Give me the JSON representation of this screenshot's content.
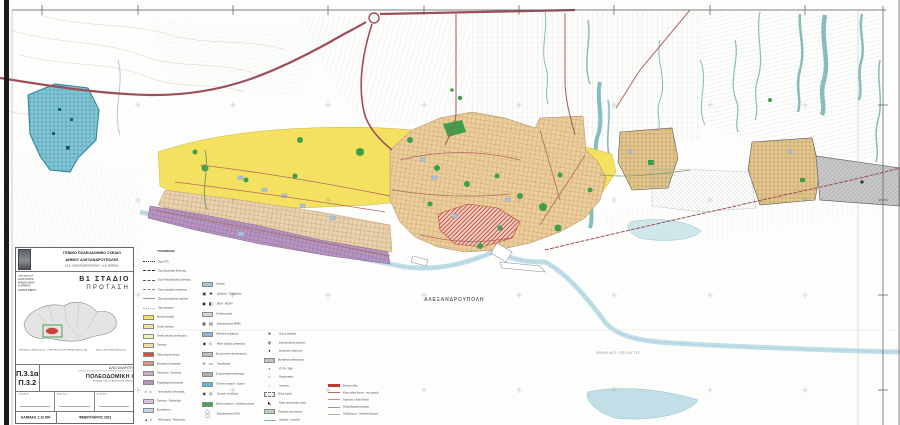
{
  "map": {
    "labels": {
      "city": "ΑΛΕΞΑΝΔΡΟΥΠΟΛΗ",
      "sea": "ΘΡΑΚΙΚΟ ΠΕΛΑΓΟΣ"
    },
    "colors": {
      "water": "#6fb3b4",
      "shore_band": "#b9dbe6",
      "highway_red": "#9d4e56",
      "road_red": "#b06a62",
      "residential_yellow": "#f4e15f",
      "urban_tan": "#ebcf9b",
      "west_tan": "#e8d2b0",
      "center_red": "#e2574a",
      "coastal_purple": "#b796c1",
      "park_green": "#3f9e4c",
      "military_blue": "#85c8d6",
      "airport_gray": "#c9c9c9",
      "lavender_blue": "#a9c4e2",
      "settlement_tan": "#e6c98f",
      "parcel_gray": "#d6d6d6"
    }
  },
  "legend": {
    "title": "ΥΠΟΜΝΗΜΑ",
    "columns": [
      {
        "entries": [
          {
            "t": "line",
            "ls": "dotted",
            "c": "#222222",
            "label": "Όριο ΓΠΣ"
          },
          {
            "t": "line",
            "ls": "dashed",
            "c": "#333333",
            "label": "Όριο Δημοτικής Ενότητας"
          },
          {
            "t": "line",
            "ls": "dashed",
            "c": "#555555",
            "label": "Όριο Πολεοδομικής Ενότητας"
          },
          {
            "t": "line",
            "ls": "dashed",
            "c": "#888888",
            "label": "Όριο περιοχής επέκτασης"
          },
          {
            "t": "line",
            "ls": "solid",
            "c": "#999999",
            "label": "Όριο εγκεκριμένου σχεδίου"
          },
          {
            "t": "line",
            "ls": "dotted",
            "c": "#aaaaaa",
            "label": "Όριο οικισμού"
          },
          {
            "t": "sw",
            "c": "#f4e15f",
            "label": "Αμιγής κατοικία"
          },
          {
            "t": "sw",
            "c": "#f6e78e",
            "label": "Γενική κατοικία"
          },
          {
            "t": "sw",
            "c": "#f4eec0",
            "label": "Γενική κατοικία (επέκταση)"
          },
          {
            "t": "sw",
            "c": "#efdfae",
            "label": "Οικισμοί"
          },
          {
            "t": "sw",
            "c": "#e2574a",
            "hatch": "#b23c33",
            "label": "Πολεοδομικό κέντρο"
          },
          {
            "t": "sw",
            "c": "#e0908a",
            "label": "Κεντρικές λειτουργίες"
          },
          {
            "t": "sw",
            "c": "#cfa8c8",
            "label": "Τουρισμός - Αναψυχή"
          },
          {
            "t": "sw",
            "c": "#b392bd",
            "label": "Παραθεριστική κατοικία"
          },
          {
            "t": "ic",
            "g": "▪ ⌂",
            "label": "Κοινωφελείς λειτουργίες"
          },
          {
            "t": "sw",
            "c": "#d9c6de",
            "label": "Πρόνοια - Περίθαλψη"
          },
          {
            "t": "sw",
            "c": "#bcd7e8",
            "label": "Εκπαίδευση"
          },
          {
            "t": "ic",
            "g": "▴ ▪",
            "label": "Αθλητισμός - Πολιτισμός"
          }
        ]
      },
      {
        "entries": [
          {
            "t": "sw",
            "c": "#9fc6d8",
            "label": "Λιμένας"
          },
          {
            "t": "ic",
            "g": "▣ ✚",
            "label": "Διοίκηση - Περίθαλψη"
          },
          {
            "t": "ic",
            "g": "◼ ◧",
            "label": "ΒΙΠΑ - ΒΙΟΠΑ"
          },
          {
            "t": "sw",
            "c": "#cfd8e2",
            "label": "Χονδρεμπόριο"
          },
          {
            "t": "ic",
            "g": "▦ ▤",
            "label": "Εγκαταστάσεις ΜΜΜ"
          },
          {
            "t": "sw",
            "c": "#8fb6d9",
            "label": "Αλιευτικό καταφύγιο"
          },
          {
            "t": "ic",
            "g": "◆ ◇",
            "label": "Μέσα μαζικής μεταφοράς"
          },
          {
            "t": "sw",
            "c": "#b5bfc9",
            "label": "Στρατιωτικές εγκαταστάσεις"
          },
          {
            "t": "ic",
            "g": "✈ ▭",
            "label": "Αεροδρόμιο"
          },
          {
            "t": "sw",
            "c": "#a9b2ba",
            "label": "Σωφρονιστικό κατάστημα"
          },
          {
            "t": "sw",
            "c": "#63b9cf",
            "label": "Υδάτινα στοιχεία - ρέματα"
          },
          {
            "t": "ic",
            "g": "◉ ◎",
            "label": "Τεχνικές υποδομές"
          },
          {
            "t": "sw",
            "c": "#46a45a",
            "label": "Αστικό πράσινο - ελεύθεροι χώροι"
          },
          {
            "t": "ic",
            "g": "◯ ◯",
            "label": "Εγκαταστάσεις ΟΚΩ"
          }
        ]
      },
      {
        "entries": [
          {
            "t": "ic",
            "g": "⊕",
            "label": "Χώροι λατρείας"
          },
          {
            "t": "ic",
            "g": "◍",
            "label": "Εγκαταστάσεις κεραιών"
          },
          {
            "t": "ic",
            "g": "●",
            "label": "Δεξαμενές ύδρευσης"
          },
          {
            "t": "sw",
            "c": "#d4d4d4",
            "hatch": "#9a9a9a",
            "label": "Βιολογικός καθαρισμός"
          },
          {
            "t": "ic",
            "g": "◐",
            "label": "ΧΥΤΑ - ΣΜΑ"
          },
          {
            "t": "ic",
            "g": "○",
            "label": "Νεκροταφείο"
          },
          {
            "t": "ic",
            "g": "◌",
            "label": "Λατομείο"
          },
          {
            "t": "swd",
            "c": "#efefef",
            "label": "Ζώνη λιμένα"
          },
          {
            "t": "ic",
            "g": "◣",
            "label": "Έργα προστασίας ακτής"
          },
          {
            "t": "sw",
            "c": "#cfe3cf",
            "hatch": "#7fae7f",
            "label": "Περιοχές προστασίας"
          },
          {
            "t": "line",
            "ls": "solid",
            "c": "#7ab0c0",
            "label": "Αιγιαλός - παραλία"
          },
          {
            "t": "line",
            "ls": "solid",
            "c": "#9ac0cc",
            "label": "Ρέμα"
          }
        ]
      },
      {
        "entries": [
          {
            "t": "line",
            "ls": "thickred",
            "c": "#c23b35",
            "label": "Εγνατία οδός"
          },
          {
            "t": "line",
            "ls": "solid",
            "c": "#b06a62",
            "label": "Κύριο οδικό δίκτυο - νέα χάραξη"
          },
          {
            "t": "line",
            "ls": "solid",
            "c": "#c98f8f",
            "label": "Πρωτεύον οδικό δίκτυο"
          },
          {
            "t": "line",
            "ls": "solid",
            "c": "#9d8f9d",
            "label": "Σιδηροδρομική γραμμή"
          },
          {
            "t": "line",
            "ls": "solid",
            "c": "#c9a8a8",
            "label": "Πεζόδρομος - ποδηλατόδρομος"
          }
        ]
      }
    ]
  },
  "titleblock": {
    "header": {
      "line1": "ΓΕΝΙΚΟ ΠΟΛΕΟΔΟΜΙΚΟ ΣΧΕΔΙΟ",
      "line2": "ΔΗΜΟΥ ΑΛΕΞΑΝΔΡΟΥΠΟΛΗΣ",
      "line3": "(Δ.Ε. ΑΛΕΞΑΝΔΡΟΥΠΟΛΗΣ - Δ.Ε. ΦΕΡΩΝ)"
    },
    "region": {
      "l1": "ΠΕΡΙΦΕΡΕΙΑ",
      "l2": "ΑΝΑΤΟΛΙΚΗΣ ΜΑΚΕΔΟΝΙΑΣ",
      "l3": "& ΘΡΑΚΗΣ",
      "l4": "ΝΟΜΟΣ ΕΒΡΟΥ"
    },
    "stage": {
      "line1": "Β1 ΣΤΑΔΙΟ",
      "line2": "ΠΡΟΤΑΣΗ"
    },
    "note_left": "ΑΝΑΔΟΧΟΙ ΜΕΛΕΤΗΤΕΣ - ΣΥΜΠΡΑΤΤΟΝΤΑ ΓΡΑΦΕΙΑ ΜΕΛΕΤΩΝ",
    "note_right": "ΘΕΣΗ ΠΕΡΙΟΧΗΣ ΜΕΛΕΤΗΣ",
    "sheet": {
      "no1": "Π.3.1α",
      "no2": "Π.3.2",
      "city": "ΑΛΕΞΑΝΔΡΟΥΠΟΛΗ",
      "title": "ΠΟΛΕΟΔΟΜΙΚΗ ΟΡΓΑΝΩΣΗ",
      "subtitle": "ΧΡΗΣΕΙΣ ΓΗΣ, ΠΥΚΝΟΤΗΤΕΣ, ΚΑΤΗΓΟΡΙΕΣ ΠΑΡΕΜΒΑΣΕΩΝ"
    },
    "sign": [
      {
        "label": "ΣΥΝΤΑΞΗ"
      },
      {
        "label": "ΕΛΕΓΧΟΣ"
      },
      {
        "label": "ΕΓΚΡΙΣΗ"
      }
    ],
    "scale": "ΚΛΙΜΑΚΑ 1:10.000",
    "date": "ΦΕΒΡΟΥΑΡΙΟΣ 2021"
  }
}
